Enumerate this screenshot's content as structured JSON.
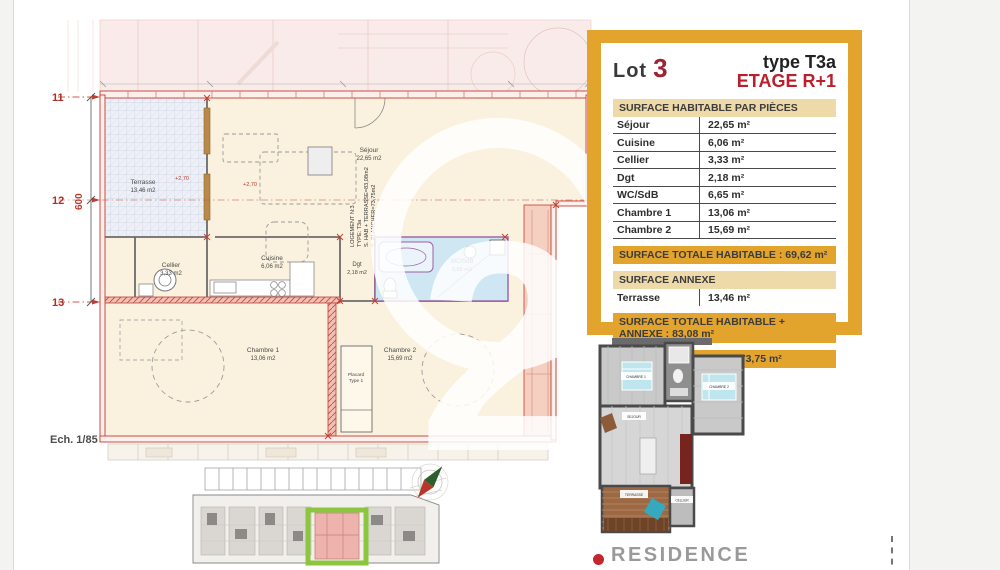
{
  "legend": {
    "lot_label": "Lot",
    "lot_number": "3",
    "type_label": "type T3a",
    "etage_label": "ETAGE R+1",
    "table1_header": "SURFACE HABITABLE PAR PIÈCES",
    "rooms": [
      {
        "name": "Séjour",
        "area": "22,65 m²"
      },
      {
        "name": "Cuisine",
        "area": "6,06 m²"
      },
      {
        "name": "Cellier",
        "area": "3,33 m²"
      },
      {
        "name": "Dgt",
        "area": "2,18 m²"
      },
      {
        "name": "WC/SdB",
        "area": "6,65 m²"
      },
      {
        "name": "Chambre 1",
        "area": "13,06 m²"
      },
      {
        "name": "Chambre 2",
        "area": "15,69 m²"
      }
    ],
    "total_habitable": "SURFACE TOTALE HABITABLE : 69,62 m²",
    "annexe_header": "SURFACE ANNEXE",
    "annexes": [
      {
        "name": "Terrasse",
        "area": "13,46 m²"
      }
    ],
    "total_plus_annexe": "SURFACE TOTALE HABITABLE + ANNEXE : 83,08 m²",
    "surface_plancher": "SURFACE PLANCHER : 73,75 m²"
  },
  "plan": {
    "scale": "Ech. 1/85",
    "grid_labels": [
      "11",
      "12",
      "13"
    ],
    "dimension_600": "600",
    "level_note": "+2,70",
    "watermark_digit": "2",
    "logement_block": {
      "line1": "LOGEMENT N:3",
      "line2": "TYPE: T3a",
      "line3": "S. HAB + TERRASSE=83,08m2",
      "line4": "S. PLANCHER=73,75m2"
    },
    "labels": {
      "terrasse": {
        "name": "Terrasse",
        "area": "13,46 m2"
      },
      "cellier": {
        "name": "Cellier",
        "area": "3,33 m2"
      },
      "cuisine": {
        "name": "Cuisine",
        "area": "6,06 m2"
      },
      "sejour": {
        "name": "Séjour",
        "area": "22,65 m2"
      },
      "dgt": {
        "name": "Dgt",
        "area": "2,18 m2"
      },
      "wcsdb": {
        "name": "WC/SdB",
        "area": "6,65 m2"
      },
      "chambre1": {
        "name": "Chambre 1",
        "area": "13,06 m2"
      },
      "chambre2": {
        "name": "Chambre 2",
        "area": "15,69 m2"
      },
      "placard_l1": "Placard",
      "placard_l2": "Type 1"
    }
  },
  "plan3d": {
    "labels": [
      "CHAMBRE 1",
      "CHAMBRE 2",
      "SEJOUR",
      "TERRASSE",
      "CELLIER"
    ]
  },
  "branding": {
    "residence": "RESIDENCE"
  },
  "colors": {
    "accent_yellow": "#e2a42c",
    "tan_header": "#eed9a9",
    "accent_red": "#b01f2b",
    "plan_wall_red": "#c43c30",
    "bathroom_blue": "#cfe7f2",
    "circulation_salmon": "#f5cfc0",
    "highlight_green": "#8cc63f",
    "logo_red": "#c1272d",
    "logo_gray": "#9a9a9a"
  }
}
